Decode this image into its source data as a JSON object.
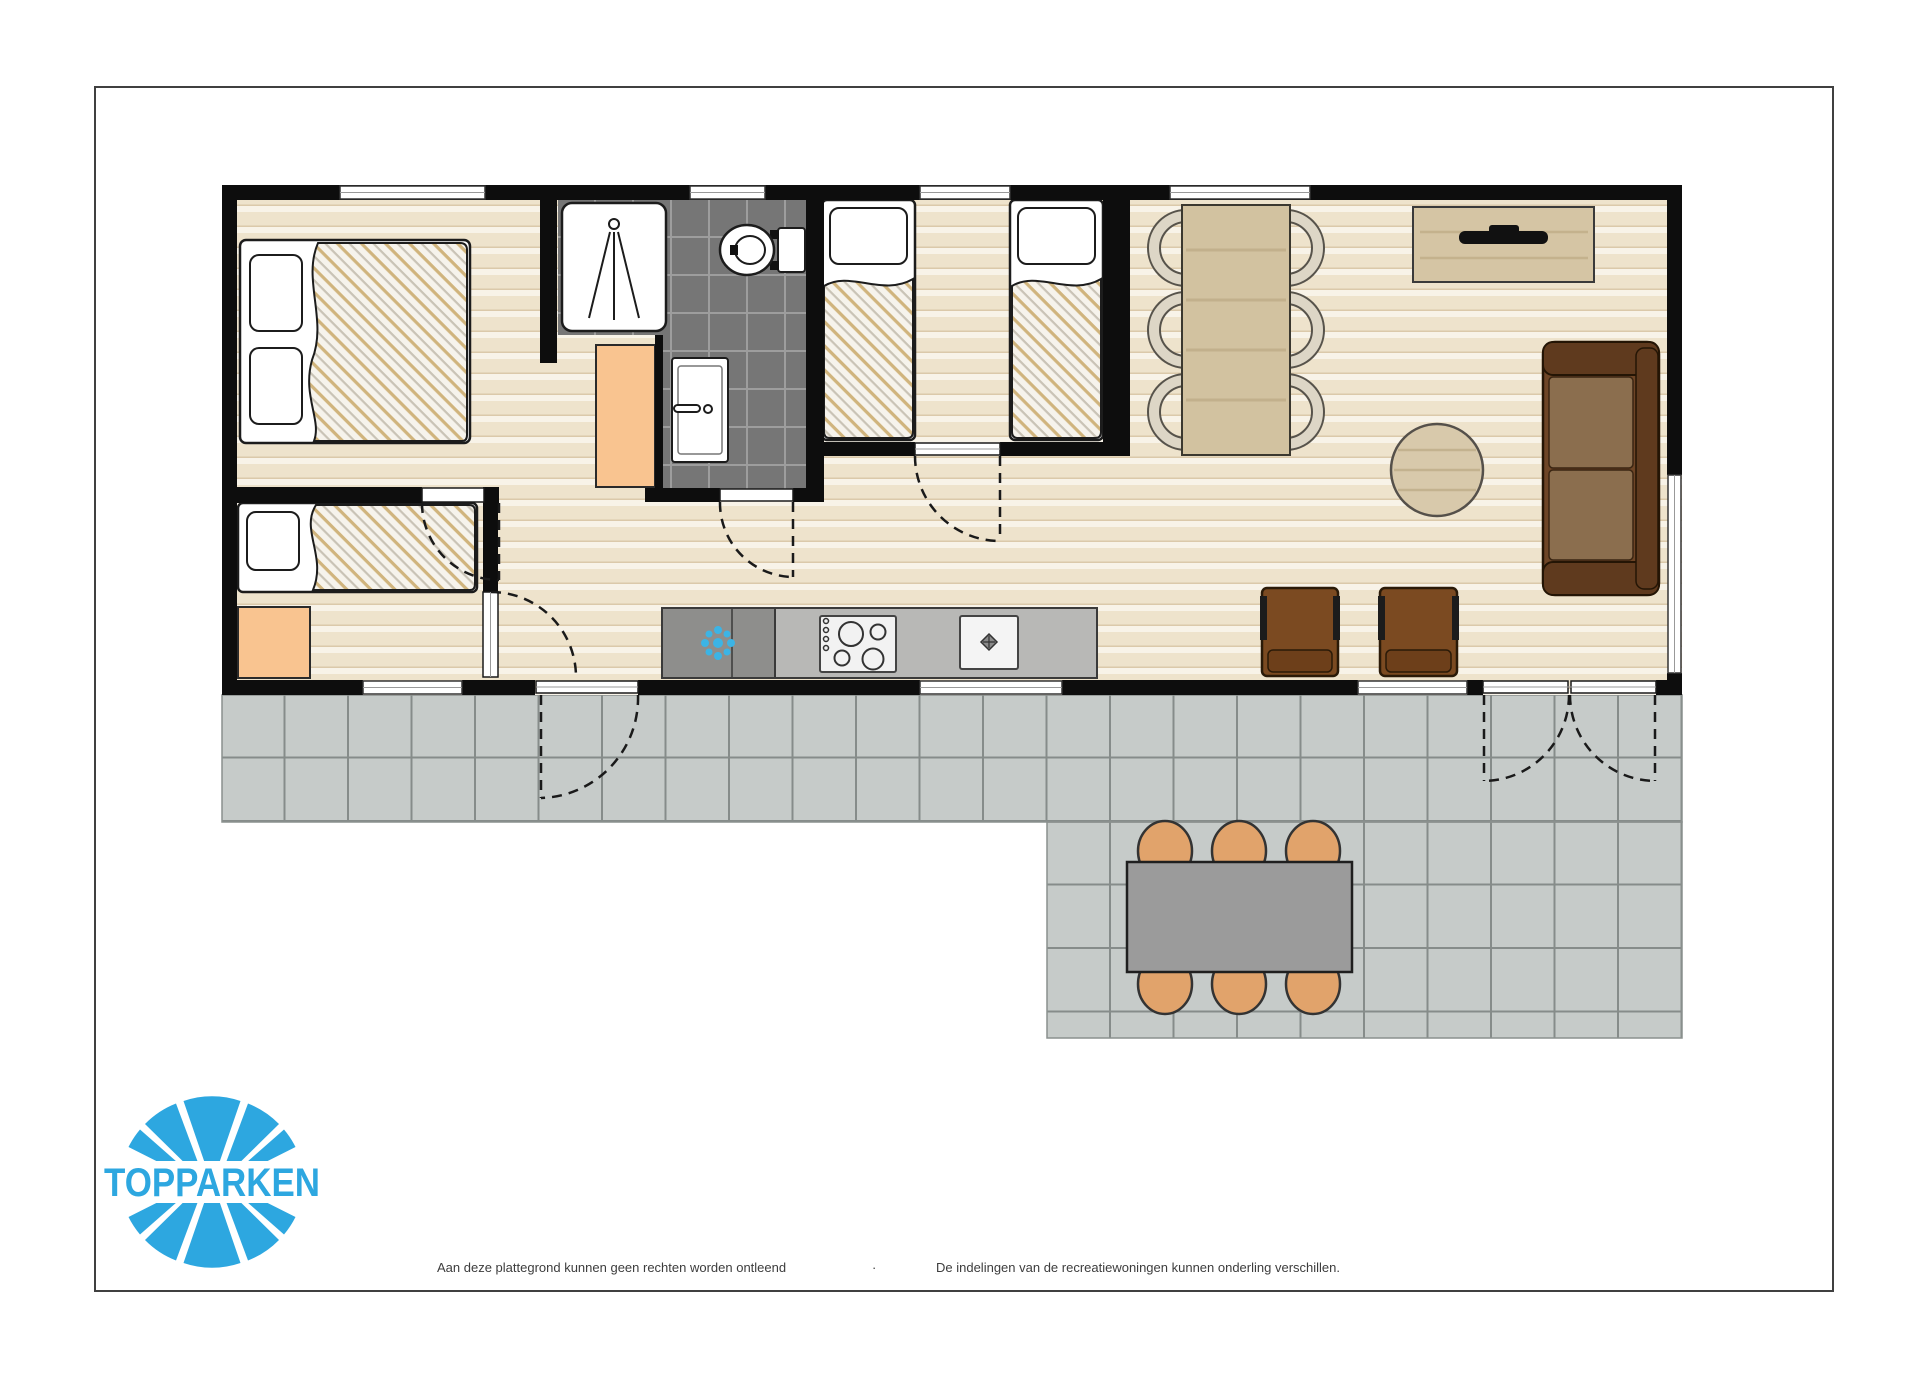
{
  "brand": {
    "name": "TOPPARKEN",
    "logo_color": "#2da7e0"
  },
  "footer": {
    "disclaimer_left": "Aan deze plattegrond kunnen geen rechten worden ontleend",
    "separator": "·",
    "disclaimer_right": "De indelingen van de recreatiewoningen kunnen onderling verschillen."
  },
  "floorplan": {
    "type": "holiday-home floor plan, top view, no text labels",
    "rooms": [
      "bedroom with double bed and wardrobe",
      "bedroom with single bed and wardrobe",
      "bedroom with two single beds",
      "bathroom with shower, toilet and washbasin",
      "hallway",
      "open living room with kitchen, dining table and sitting area",
      "tiled terrace with garden table"
    ],
    "furniture": [
      "double-bed",
      "single-bed",
      "single-bed",
      "single-bed",
      "wardrobe",
      "wardrobe",
      "shower-tray",
      "toilet",
      "washbasin",
      "kitchen-counter",
      "fridge-freezer",
      "cooktop",
      "sink",
      "dining-table",
      "6 dining-chairs",
      "tv-cabinet",
      "tv",
      "sofa",
      "round-side-table",
      "2 armchairs",
      "garden-table",
      "6 garden-chairs"
    ],
    "colors": {
      "wall": "#0d0d0d",
      "floor_base": "#eee3cc",
      "terrace_tile": "#c6cbc9",
      "terrace_grout": "#868c8a",
      "bathroom_tile": "#767676",
      "wardrobe_orange": "#f9c490",
      "wood_light": "#d5c5a4",
      "sofa_brown": "#6e4526",
      "armchair_brown": "#7b4a21",
      "garden_chair_orange": "#e1a36b",
      "counter_grey": "#b8b8b6",
      "fridge_grey": "#8e8e8c",
      "snowflake_blue": "#3cb4e5",
      "logo_blue": "#2da7e0"
    }
  }
}
